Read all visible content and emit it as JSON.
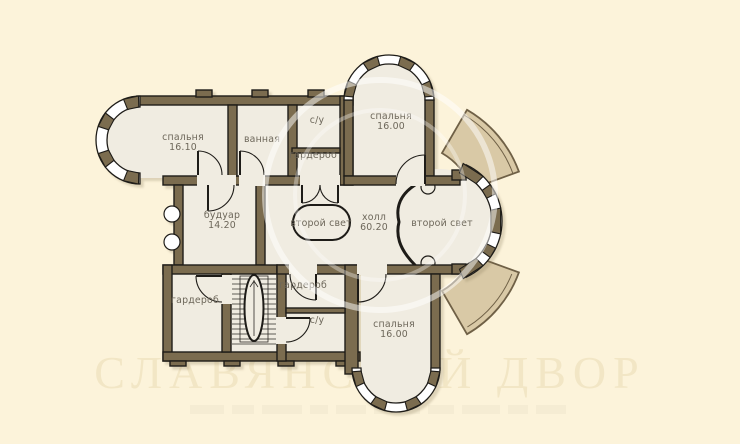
{
  "title": {
    "text": "план второго этажа"
  },
  "watermark": {
    "text": "СЛАВЯНСКИЙ ДВОР"
  },
  "colors": {
    "background": "#fcf3da",
    "wall": "#7b6c4f",
    "outline": "#1e1c18",
    "floor": "#f0ece1",
    "terrace_fan": "#d9c9a6",
    "label_text": "#6d675a",
    "title_text": "#4e4e4e",
    "watermark_text": "#f2e6c5"
  },
  "rooms": {
    "bedroom_left": {
      "label": "спальня",
      "area": "16.10"
    },
    "bathroom": {
      "label": "ванная"
    },
    "wc_top": {
      "label": "с/у"
    },
    "wardrobe_top": {
      "label": "гардероб"
    },
    "bedroom_top": {
      "label": "спальня",
      "area": "16.00"
    },
    "boudoir": {
      "label": "будуар",
      "area": "14.20"
    },
    "void_center": {
      "label": "второй свет"
    },
    "hall": {
      "label": "холл",
      "area": "60.20"
    },
    "void_right": {
      "label": "второй свет"
    },
    "wardrobe_left": {
      "label": "гардероб"
    },
    "wardrobe_mid": {
      "label": "гардероб"
    },
    "wc_bottom": {
      "label": "с/у"
    },
    "bedroom_bottom": {
      "label": "спальня",
      "area": "16.00"
    }
  }
}
